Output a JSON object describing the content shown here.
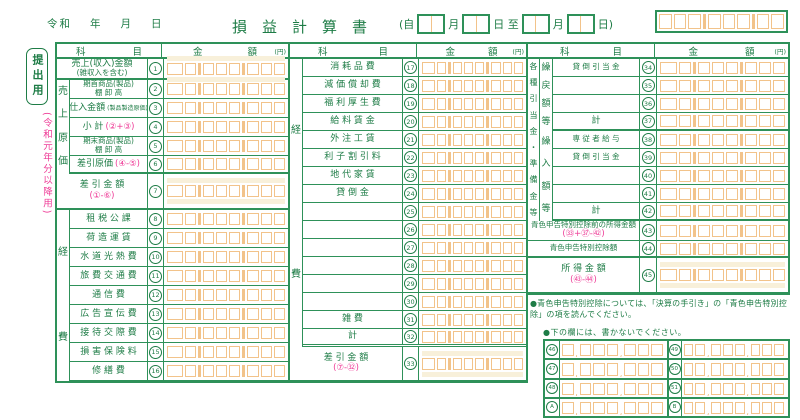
{
  "colors": {
    "green_line": "#2e9159",
    "green_text": "#1e7c46",
    "pink": "#ee3a96",
    "orange_cell": "#f2c38a",
    "cream": "#f8f0da"
  },
  "header": {
    "era": "令和",
    "year_label": "年",
    "month_label": "月",
    "day_label": "日",
    "title": "損益計算書",
    "period": {
      "open": "(自",
      "m1": "月",
      "mid": "日 至",
      "m2": "月",
      "close": "日)"
    }
  },
  "side": {
    "submit": "提出用",
    "edition": "(令和元年分以降用)"
  },
  "table_headers": {
    "item": "科 目",
    "amount": "金 額",
    "yen": "(円)"
  },
  "left_table": {
    "bands": {
      "cost": "売上原価",
      "expense": "経費"
    },
    "rows": [
      {
        "num": "1",
        "l1": "売上(収入)金額",
        "l2": "(雑収入を含む)",
        "tall": true,
        "thick": true,
        "span": true
      },
      {
        "num": "2",
        "l1": "期首商品(製品)",
        "l2": "棚 卸 高",
        "small": true
      },
      {
        "num": "3",
        "l1": "仕入金額",
        "paren": "(製品製造原価)"
      },
      {
        "num": "4",
        "l1": "小  計",
        "f": "(②+③)"
      },
      {
        "num": "5",
        "l1": "期末商品(製品)",
        "l2": "棚 卸 高",
        "small": true
      },
      {
        "num": "6",
        "l1": "差引原価",
        "f": "(④-⑤)",
        "thick": true
      },
      {
        "num": "7",
        "l1": "差 引 金 額",
        "fb": "(①-⑥)",
        "tall": true,
        "thick": true,
        "span": true
      },
      {
        "num": "8",
        "l1": "租 税 公 課"
      },
      {
        "num": "9",
        "l1": "荷 造 運 賃"
      },
      {
        "num": "10",
        "l1": "水 道 光 熱 費"
      },
      {
        "num": "11",
        "l1": "旅 費 交 通 費"
      },
      {
        "num": "12",
        "l1": "通   信   費"
      },
      {
        "num": "13",
        "l1": "広 告 宣 伝 費"
      },
      {
        "num": "14",
        "l1": "接 待 交 際 費"
      },
      {
        "num": "15",
        "l1": "損 害 保 険 料"
      },
      {
        "num": "16",
        "l1": "修   繕   費"
      }
    ]
  },
  "middle_table": {
    "band": "経費",
    "rows": [
      {
        "num": "17",
        "l1": "消 耗 品 費"
      },
      {
        "num": "18",
        "l1": "減 価 償 却 費"
      },
      {
        "num": "19",
        "l1": "福 利 厚 生 費"
      },
      {
        "num": "20",
        "l1": "給 料 賃 金"
      },
      {
        "num": "21",
        "l1": "外 注 工 賃"
      },
      {
        "num": "22",
        "l1": "利 子 割 引 料"
      },
      {
        "num": "23",
        "l1": "地 代 家 賃"
      },
      {
        "num": "24",
        "l1": "貸   倒   金"
      },
      {
        "num": "25"
      },
      {
        "num": "26"
      },
      {
        "num": "27"
      },
      {
        "num": "28"
      },
      {
        "num": "29"
      },
      {
        "num": "30"
      },
      {
        "num": "31",
        "l1": "雑     費"
      },
      {
        "num": "32",
        "l1": "計",
        "dbl": true
      },
      {
        "num": "33",
        "l1": "差 引 金 額",
        "fb": "(⑦-㉜)",
        "tall": true,
        "span": true
      }
    ]
  },
  "right_table": {
    "outer_band": "各種引当金・準備金等",
    "inner_band_1": "繰戻額等",
    "inner_band_2": "繰入額等",
    "rows": [
      {
        "num": "34",
        "l1": "貸 倒 引 当 金",
        "small": true
      },
      {
        "num": "35"
      },
      {
        "num": "36"
      },
      {
        "num": "37",
        "l1": "計",
        "thick": true
      },
      {
        "num": "38",
        "l1": "専 従 者 給 与",
        "small": true
      },
      {
        "num": "39",
        "l1": "貸 倒 引 当 金",
        "small": true
      },
      {
        "num": "40"
      },
      {
        "num": "41"
      },
      {
        "num": "42",
        "l1": "計",
        "thick": true
      },
      {
        "num": "43",
        "l1": "青色申告特別控除前の所得金額",
        "fb": "(㉝+㊲-㊷)",
        "span": true,
        "small": true
      },
      {
        "num": "44",
        "l1": "青色申告特別控除額",
        "span": true,
        "small": true,
        "thick": true
      },
      {
        "num": "45",
        "l1": "所 得 金 額",
        "fb": "(㊸-㊹)",
        "tall": true,
        "span": true
      }
    ]
  },
  "notes": {
    "n1": "●青色申告特別控除については、「決算の手引き」の「青色申告特別控除」の項を読んでください。",
    "n2": "●下の欄には、書かないでください。"
  },
  "bottom_grid": {
    "left_nums": [
      "46",
      "47",
      "48",
      "A"
    ],
    "right_nums": [
      "49",
      "50",
      "51",
      "B"
    ]
  }
}
